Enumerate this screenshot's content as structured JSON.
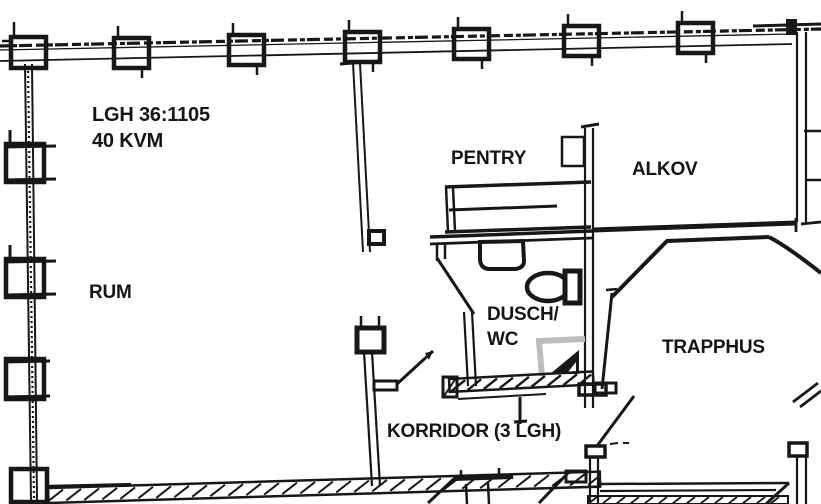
{
  "apartment": {
    "id": "LGH 36:1105",
    "area": "40 KVM"
  },
  "rooms": {
    "rum": "RUM",
    "pentry": "PENTRY",
    "alkov": "ALKOV",
    "dusch_wc_line1": "DUSCH/",
    "dusch_wc_line2": "WC",
    "trapphus": "TRAPPHUS",
    "korridor": "KORRIDOR (3 LGH)"
  },
  "colors": {
    "ink": "#171717",
    "paper": "#ffffff",
    "shower_gray": "#bcbcbc"
  }
}
